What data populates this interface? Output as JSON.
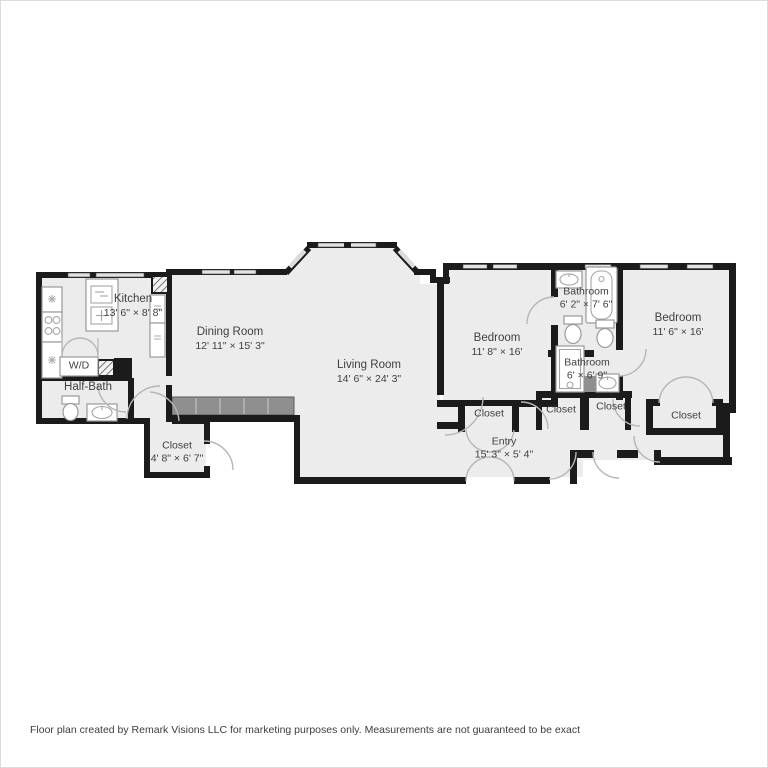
{
  "footer": {
    "disclaimer": "Floor plan created by Remark Visions LLC for marketing purposes only. Measurements are not guaranteed to be exact"
  },
  "palette": {
    "wall": "#1b1b1b",
    "floor": "#ececec",
    "cabinet_fill": "#8f8f8f",
    "window_fill": "#e2e2e2",
    "door_arc": "#b6b6b6",
    "fixture_stroke": "#9a9a9a",
    "label_text": "#3f3f3f",
    "page_background": "#ffffff"
  },
  "labels": [
    {
      "name": "Kitchen",
      "dims": "13' 6\" × 8' 8\""
    },
    {
      "name": "Dining Room",
      "dims": "12' 11\" × 15' 3\""
    },
    {
      "name": "Living Room",
      "dims": "14' 6\" × 24' 3\""
    },
    {
      "name": "Bedroom",
      "dims": "11' 8\" × 16'"
    },
    {
      "name": "Bathroom",
      "dims": "6' 2\" × 7' 6\""
    },
    {
      "name": "Bathroom",
      "dims": "6' × 6' 9\""
    },
    {
      "name": "Bedroom",
      "dims": "11' 6\" × 16'"
    },
    {
      "name": "Half-Bath",
      "dims": ""
    },
    {
      "name": "W/D",
      "dims": ""
    },
    {
      "name": "Closet",
      "dims": "4' 8\" × 6' 7\""
    },
    {
      "name": "Entry",
      "dims": "15' 3\" × 5' 4\""
    },
    {
      "name": "Closet",
      "dims": ""
    },
    {
      "name": "Closet",
      "dims": ""
    },
    {
      "name": "Closet",
      "dims": ""
    },
    {
      "name": "Closet",
      "dims": ""
    }
  ]
}
